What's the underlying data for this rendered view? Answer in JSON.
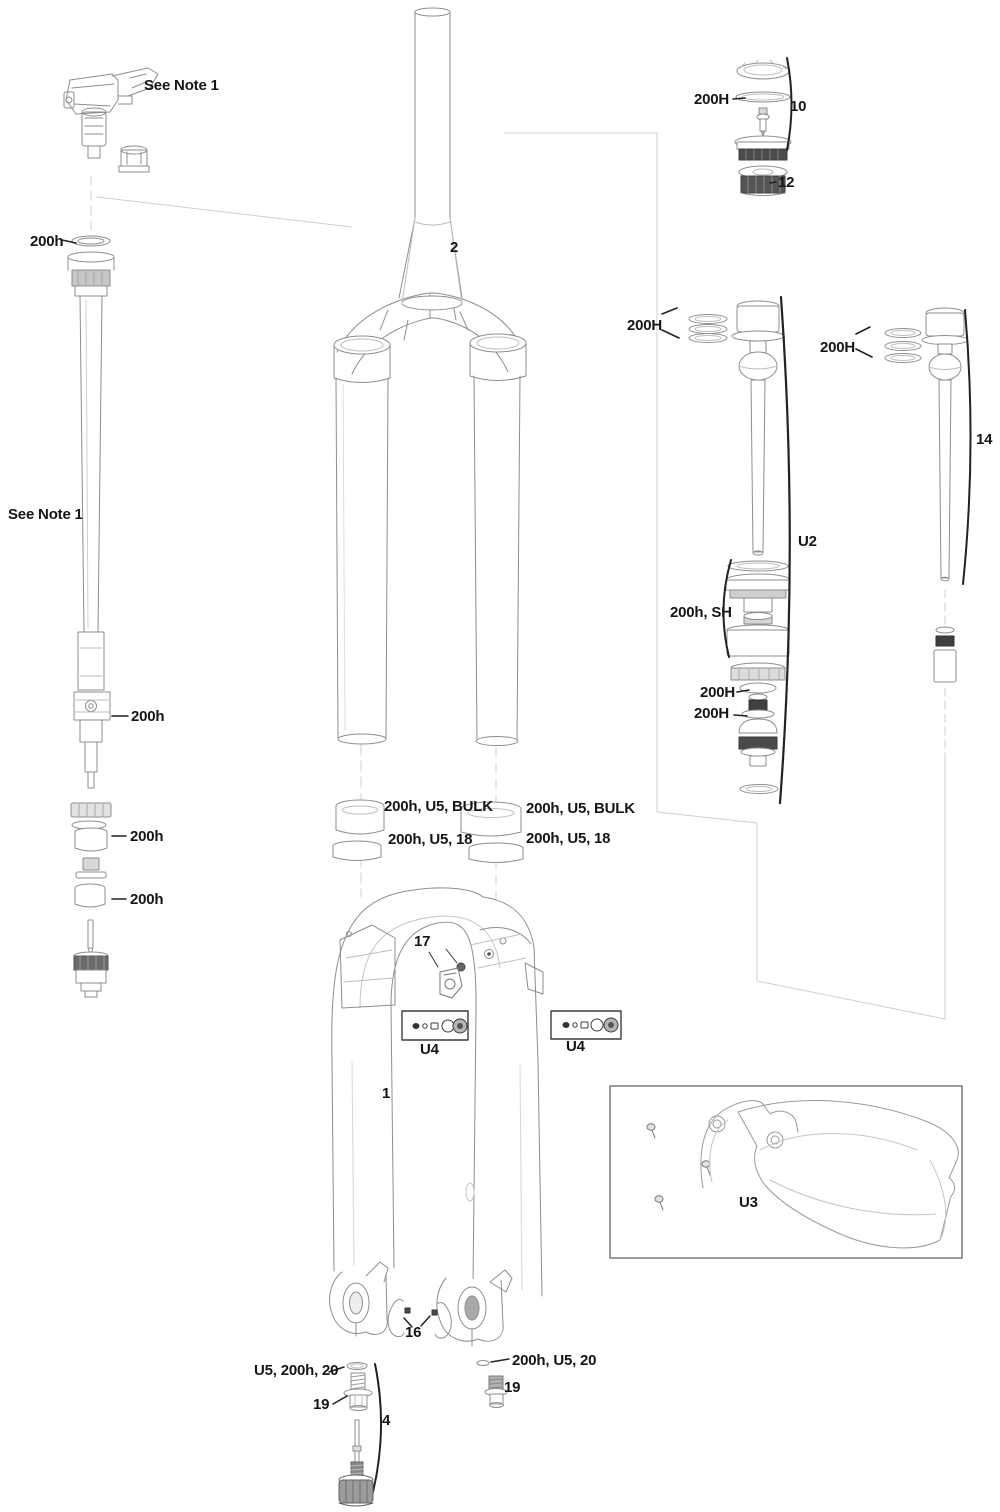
{
  "diagram_title": "Suspension fork exploded service diagram",
  "colors": {
    "ink": "#151515",
    "line": "#8e8e8e",
    "faint_line": "#c9c9c9",
    "dark_fill": "#454545"
  },
  "labels": {
    "note_top": "See Note 1",
    "note_left": "See Note 1",
    "h200_left_top": "200h",
    "part2": "2",
    "H200_cap": "200H",
    "part10": "10",
    "part12": "12",
    "H200_u2": "200H",
    "H200_14": "200H",
    "part14": "14",
    "partU2": "U2",
    "sh200h": "200h, SH",
    "H200_a": "200H",
    "H200_b": "200H",
    "h200_lockout": "200h",
    "h200_mid1": "200h",
    "h200_mid2": "200h",
    "bulk_left": "200h, U5, BULK",
    "s18_left": "200h, U5, 18",
    "bulk_right": "200h, U5, BULK",
    "s18_right": "200h, U5, 18",
    "part17": "17",
    "u4_left": "U4",
    "u4_right": "U4",
    "part1": "1",
    "u3": "U3",
    "part16": "16",
    "u5_200h_20_left": "U5, 200h, 20",
    "part19_left": "19",
    "part4": "4",
    "h200_u5_20_right": "200h, U5, 20",
    "part19_right": "19"
  }
}
